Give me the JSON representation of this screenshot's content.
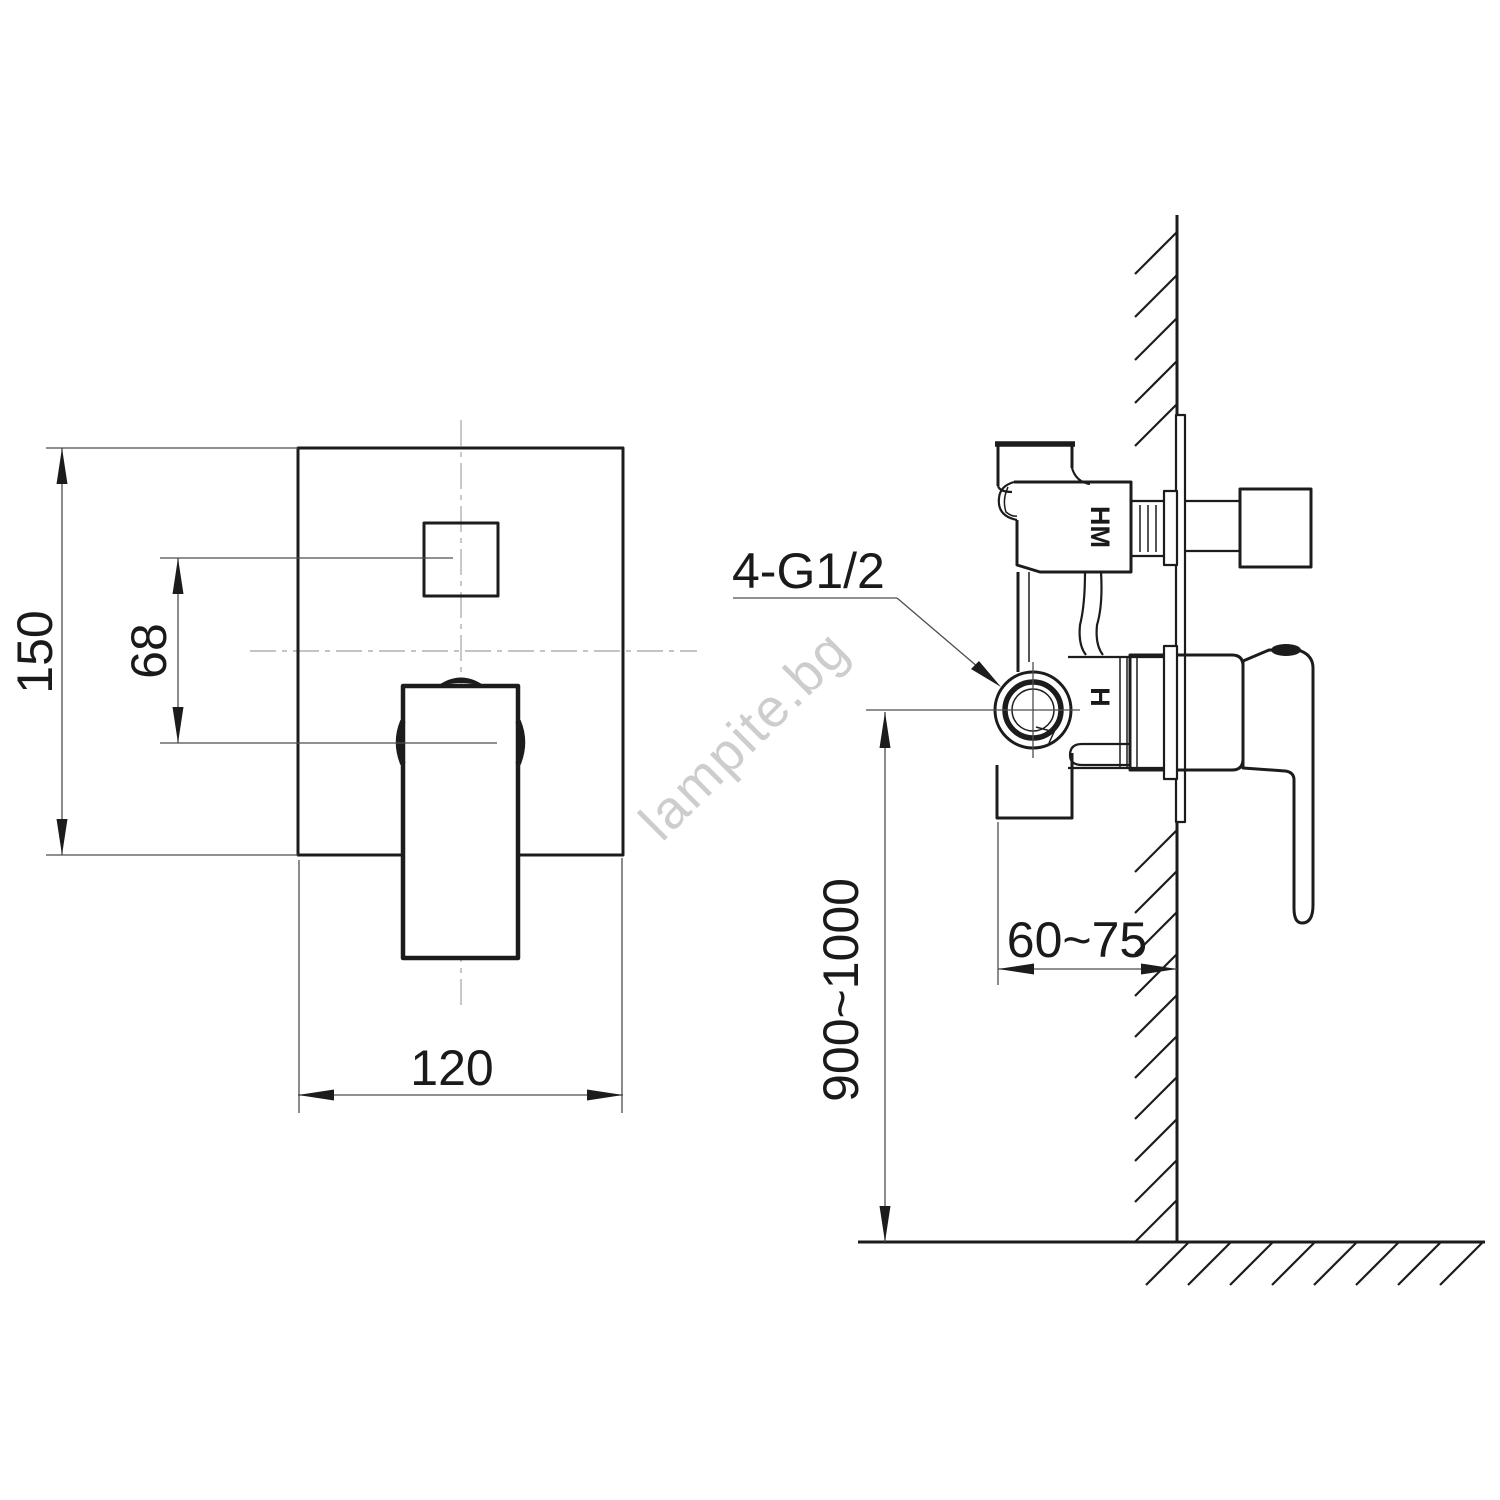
{
  "drawing": {
    "front_view": {
      "dim_height": "150",
      "dim_offset": "68",
      "dim_width": "120"
    },
    "side_view": {
      "thread_callout": "4-G1/2",
      "dim_depth": "60~75",
      "dim_mount_height": "900~1000",
      "label_port_top": "HM",
      "label_port_mid": "H"
    },
    "watermark": "lampite.bg",
    "colors": {
      "line": "#1c1c1c",
      "dim": "#4d4d4d",
      "centerline": "#b0b0b0",
      "watermark": "#c9c9c9",
      "bg": "#ffffff"
    }
  }
}
